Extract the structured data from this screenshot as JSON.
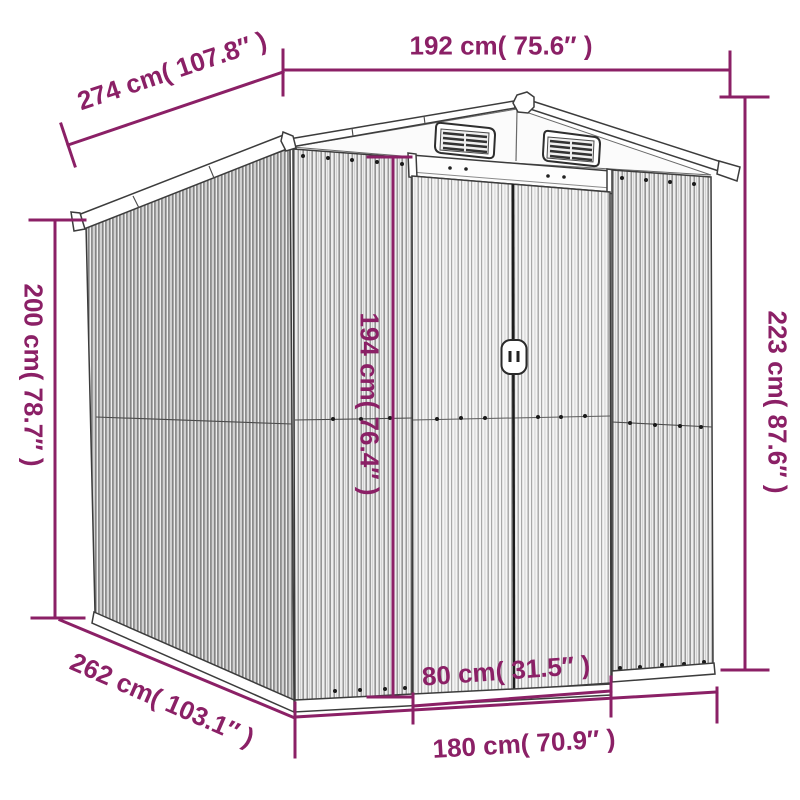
{
  "colors": {
    "dimension_annotation": "#8B2066",
    "drawing_outline": "#3C3C3C",
    "background": "#FFFFFF"
  },
  "diagram": {
    "subject": "Metal garden shed line drawing with dimension annotations",
    "units": [
      "cm",
      "in"
    ],
    "dimensions": [
      {
        "id": "top-width",
        "value_cm": 192,
        "value_in": 75.6,
        "label": "192 cm( 75.6″ )"
      },
      {
        "id": "roof-depth",
        "value_cm": 274,
        "value_in": 107.8,
        "label": "274 cm( 107.8″ )"
      },
      {
        "id": "left-height",
        "value_cm": 200,
        "value_in": 78.7,
        "label": "200 cm( 78.7″ )"
      },
      {
        "id": "door-height",
        "value_cm": 194,
        "value_in": 76.4,
        "label": "194 cm( 76.4″ )"
      },
      {
        "id": "right-height",
        "value_cm": 223,
        "value_in": 87.6,
        "label": "223 cm( 87.6″ )"
      },
      {
        "id": "door-width",
        "value_cm": 80,
        "value_in": 31.5,
        "label": "80 cm( 31.5″ )"
      },
      {
        "id": "base-depth",
        "value_cm": 262,
        "value_in": 103.1,
        "label": "262 cm( 103.1″ )"
      },
      {
        "id": "base-width",
        "value_cm": 180,
        "value_in": 70.9,
        "label": "180 cm( 70.9″ )"
      }
    ]
  }
}
